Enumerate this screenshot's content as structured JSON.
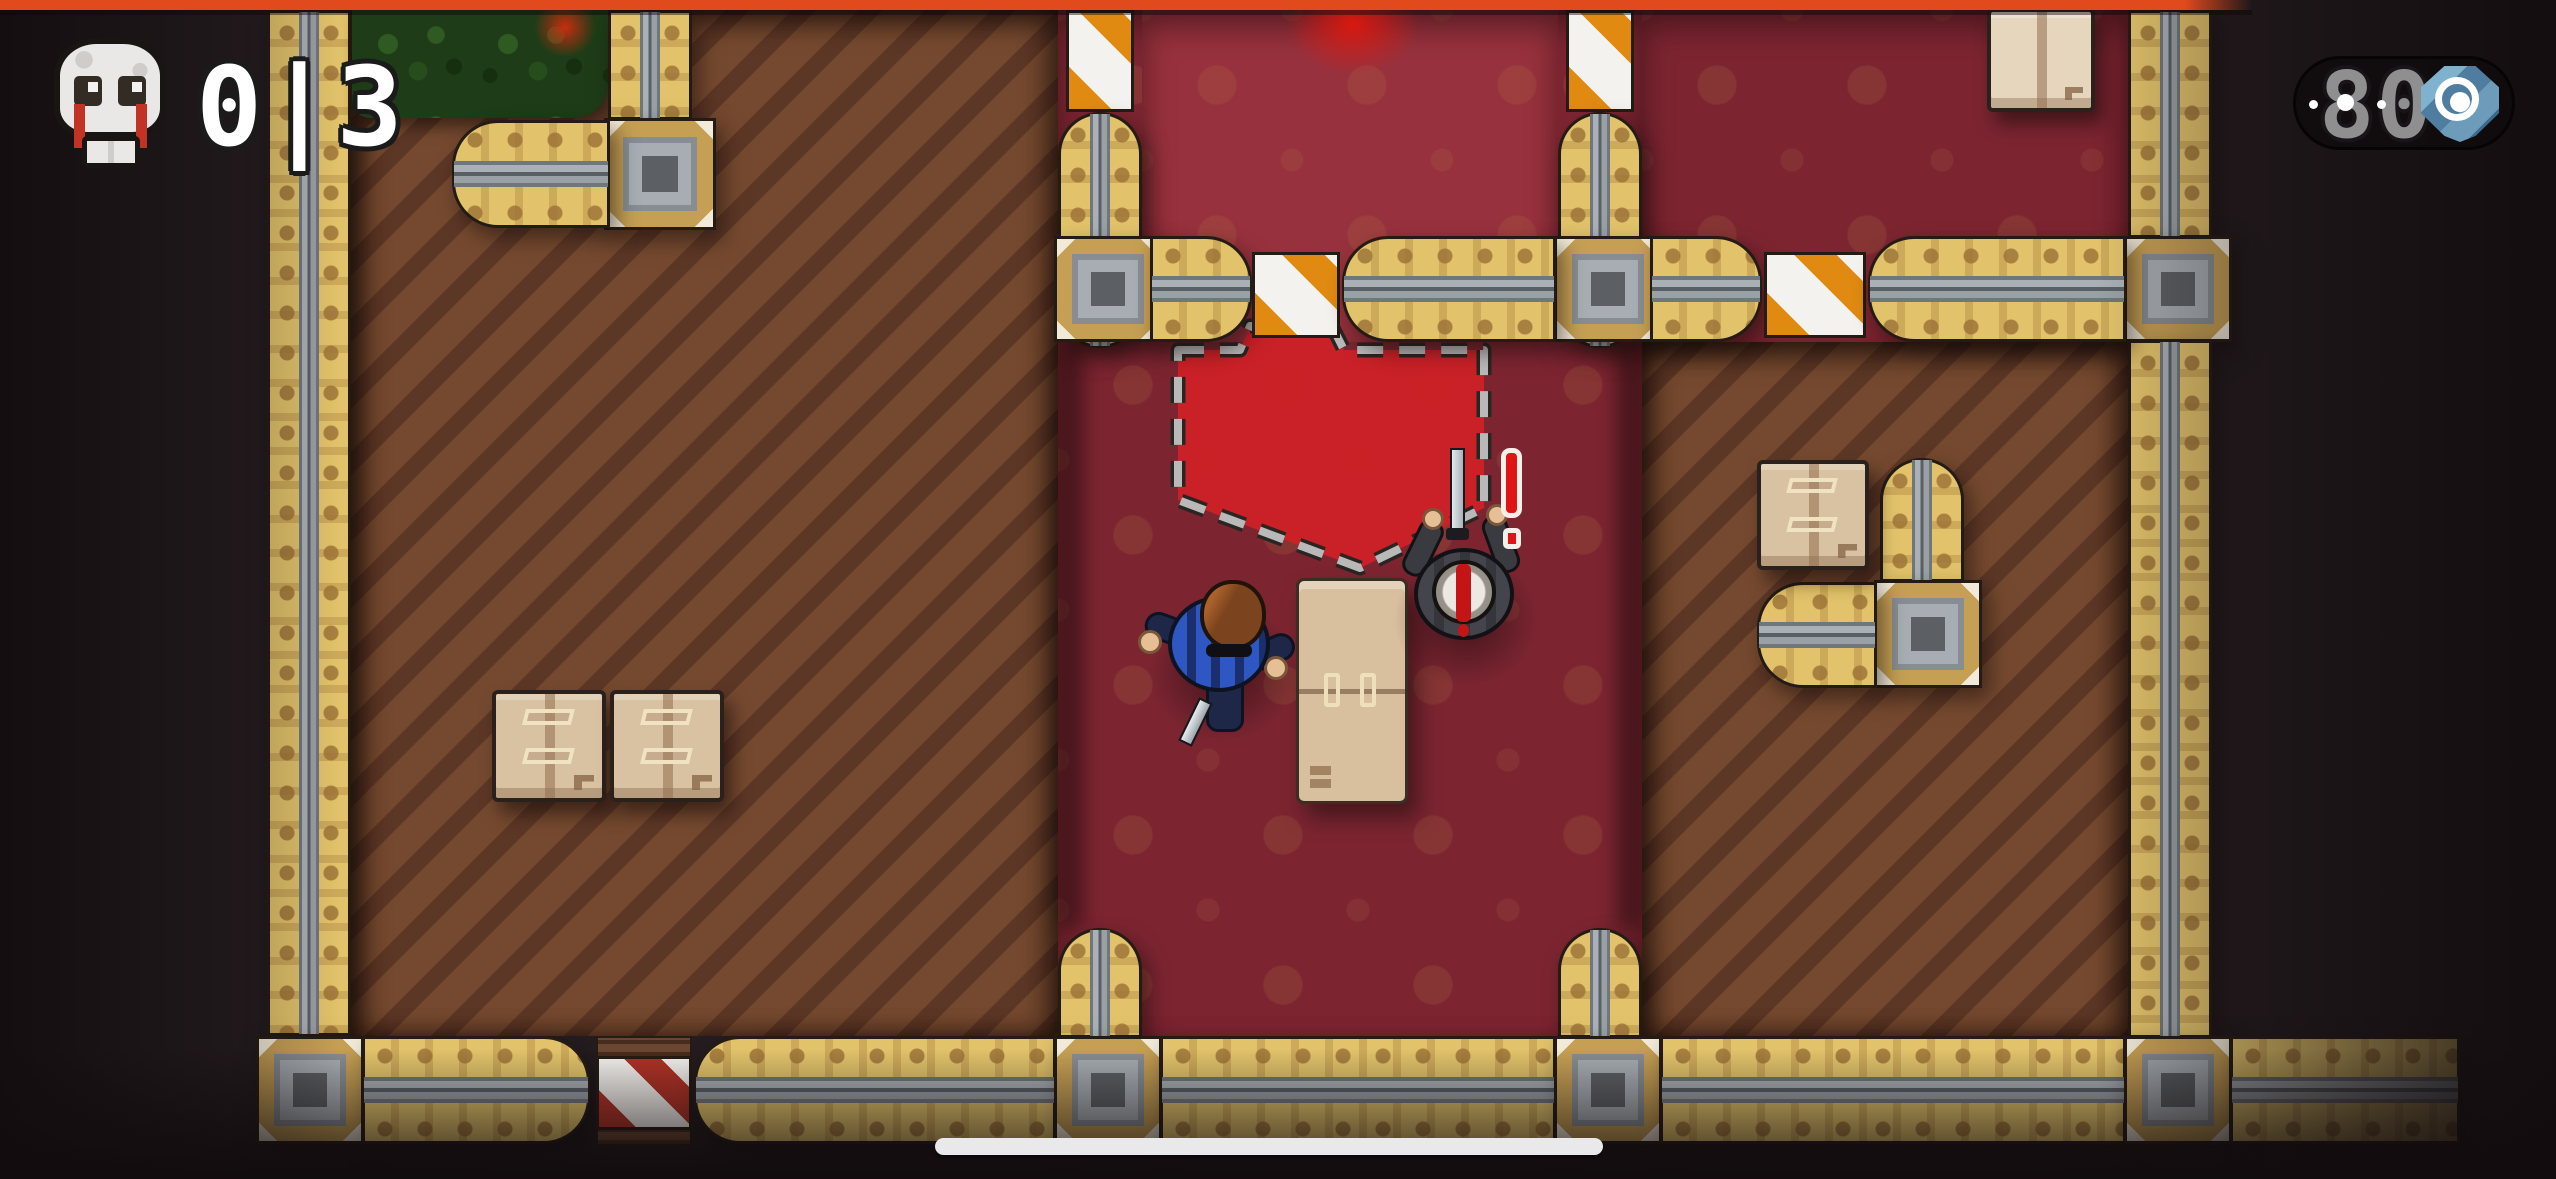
{
  "hud": {
    "kills": {
      "icon": "skull-icon",
      "value": "0|3"
    },
    "resource": {
      "icon": "target-gem-icon",
      "value": "80"
    }
  },
  "alert": {
    "symbol": "!"
  },
  "entities": {
    "player": "player-with-knife",
    "enemy": "alerted-enemy-with-katana",
    "props": [
      "table",
      "crate",
      "crate",
      "crate",
      "crate-light",
      "bush"
    ],
    "barricades": [
      "orange-white",
      "orange-white",
      "orange-white",
      "orange-white",
      "red-white"
    ],
    "zones": [
      "vision-zone-dashed"
    ]
  },
  "colors": {
    "top_bar": "#e04a1d",
    "wall": "#e2c36b",
    "wall_rail": "#aab1b6",
    "wood_floor": "#6f4531",
    "carpet": "#7c2531",
    "carpet_bright": "#97313d",
    "vision_zone": "#ce2127",
    "barrier_orange": "#e08a12",
    "barrier_red": "#b03226",
    "alert": "#e01414",
    "hud_text": "#ffffff",
    "resource_text": "#8f8f8f"
  }
}
